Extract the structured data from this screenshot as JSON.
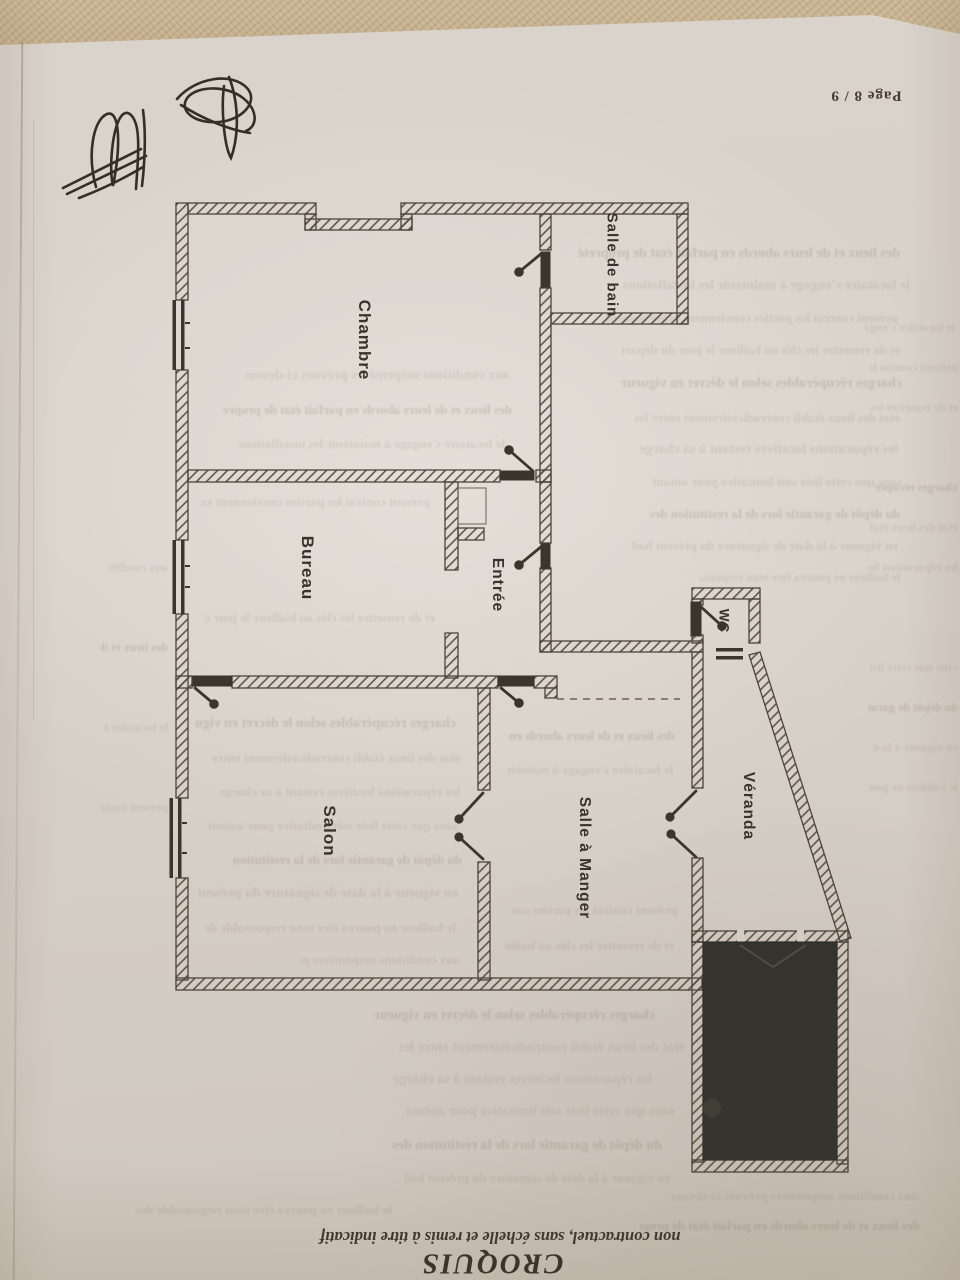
{
  "page": {
    "page_number": "Page 8 / 9",
    "footer": {
      "title": "CROQUIS",
      "disclaimer": "non contractuel, sans échelle et remis à titre indicatif"
    }
  },
  "floor_plan": {
    "type": "apartment-sketch",
    "rooms": [
      {
        "id": "salle-de-bain",
        "label": "Salle de bain"
      },
      {
        "id": "chambre",
        "label": "Chambre"
      },
      {
        "id": "bureau",
        "label": "Bureau"
      },
      {
        "id": "entree",
        "label": "Entrée"
      },
      {
        "id": "wc",
        "label": "WC"
      },
      {
        "id": "salon",
        "label": "Salon"
      },
      {
        "id": "salle-a-manger",
        "label": "Salle à Manger"
      },
      {
        "id": "veranda",
        "label": "Véranda"
      }
    ],
    "features": {
      "dark_filled_room": "bottom-right room filled solid dark (label illegible)",
      "double_doors": [
        "salon / salle à manger",
        "salle à manger / véranda"
      ],
      "dashed_opening": "between entrée and véranda",
      "windows_left_wall": 3
    }
  },
  "handwriting": {
    "description": "two illegible handwritten initial scribbles, top-left"
  },
  "bleedthrough": {
    "description": "illegible mirrored text showing through from the reverse side of the sheet",
    "texture_lines": [
      "des lieux et de leurs abords en parfait état de propreté",
      "le locataire s'engage à maintenir les installations",
      "présent contrat les parties conviennent expressément",
      "et de remettre les clés au bailleur le jour du départ",
      "charges récupérables selon le décret en vigueur",
      "état des lieux établi contradictoirement entre les",
      "les réparations locatives restant à sa charge",
      "sans que cette liste soit limitative pour autant",
      "du dépôt de garantie lors de la restitution des",
      "en vigueur à la date de signature du présent bail",
      "le bailleur ne pourra être tenu responsable des",
      "aux conditions suspensives prévues ci-dessus"
    ]
  },
  "colors": {
    "paper": "#d8d2ca",
    "fabric_background": "#c5af8d",
    "ink": "#3b352c",
    "wall_hatch": "#564d3f",
    "dark_room_fill": "#33322d"
  }
}
